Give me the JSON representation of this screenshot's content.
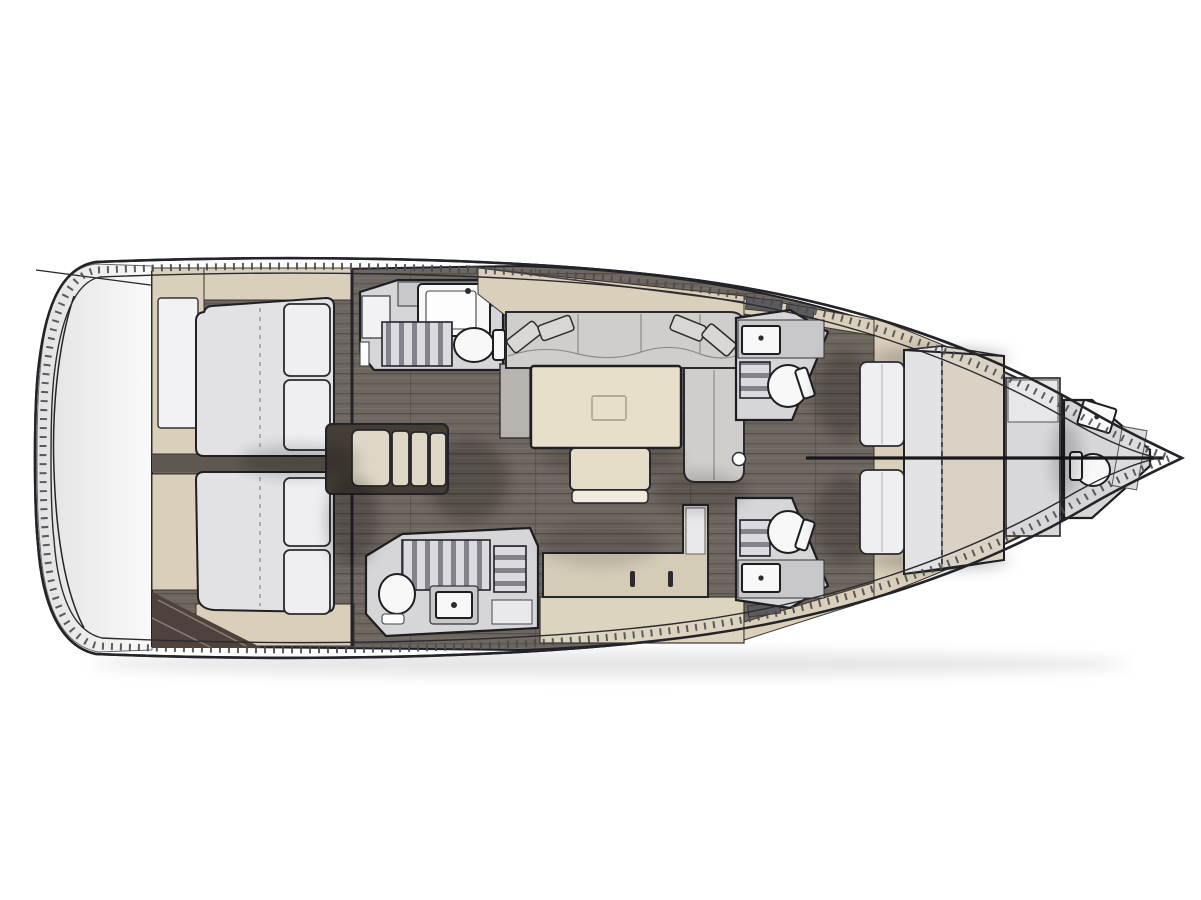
{
  "figure": {
    "title": "Sailing yacht interior layout plan, top view with bow pointing right",
    "background": "#ffffff"
  },
  "palette": {
    "hull_outline": "#23232a",
    "deck_white": "#fdfdfd",
    "transom_gray_start": "#e2e2e2",
    "transom_gray_end": "#fafafa",
    "floor_wood": "#6e6660",
    "floor_wood_dark": "#5f5852",
    "cabinetry_beige": "#d9cfba",
    "counter_beige": "#d5ccb8",
    "band_beige": "#ddd4c0",
    "mattress_gray": "#e2e1e4",
    "mattress_beige": "#d9d2c5",
    "pillow_white": "#efeef1",
    "sofa_gray": "#cfcecb",
    "cushion_gray": "#d9d7d4",
    "table_cream": "#e7dfca",
    "head_floor_gray": "#d6d5d7",
    "counter_gray": "#c8c7c9",
    "grate_light": "#dbdadf",
    "grate_dark": "#84828a",
    "steps_beige": "#ded7c5",
    "locker_brown": "#4e423b",
    "shadow": "rgba(0,0,0,0.22)"
  },
  "rooms": {
    "transom": {
      "label": "Stern swim platform"
    },
    "aft_cabin_upper": {
      "label": "Aft double cabin, upper side, berth with two pillows"
    },
    "aft_cabin_lower": {
      "label": "Aft double cabin, lower side, berth with two pillows"
    },
    "head_aft_upper": {
      "label": "Aft head with sink, shower grating and toilet, upper side"
    },
    "head_aft_lower": {
      "label": "Aft head with shower grating, toilet and sink, lower side"
    },
    "companionway": {
      "label": "Companionway entry steps"
    },
    "saloon": {
      "label": "Saloon with U-shaped sofa, dining table and bench"
    },
    "galley": {
      "label": "Galley counter with drawers"
    },
    "head_mid_upper": {
      "label": "Midship en-suite head, upper side"
    },
    "head_mid_lower": {
      "label": "Midship en-suite head, lower side"
    },
    "owner_cabin": {
      "label": "Forward owner cabin with island double berth and bench"
    },
    "bow_head": {
      "label": "Bow head with toilet and sink"
    }
  },
  "fixtures": {
    "toilets": 5,
    "sinks": 5,
    "shower_gratings": 4,
    "double_berths": 3,
    "sofas": 1,
    "tables": 1,
    "step_count": 4
  }
}
